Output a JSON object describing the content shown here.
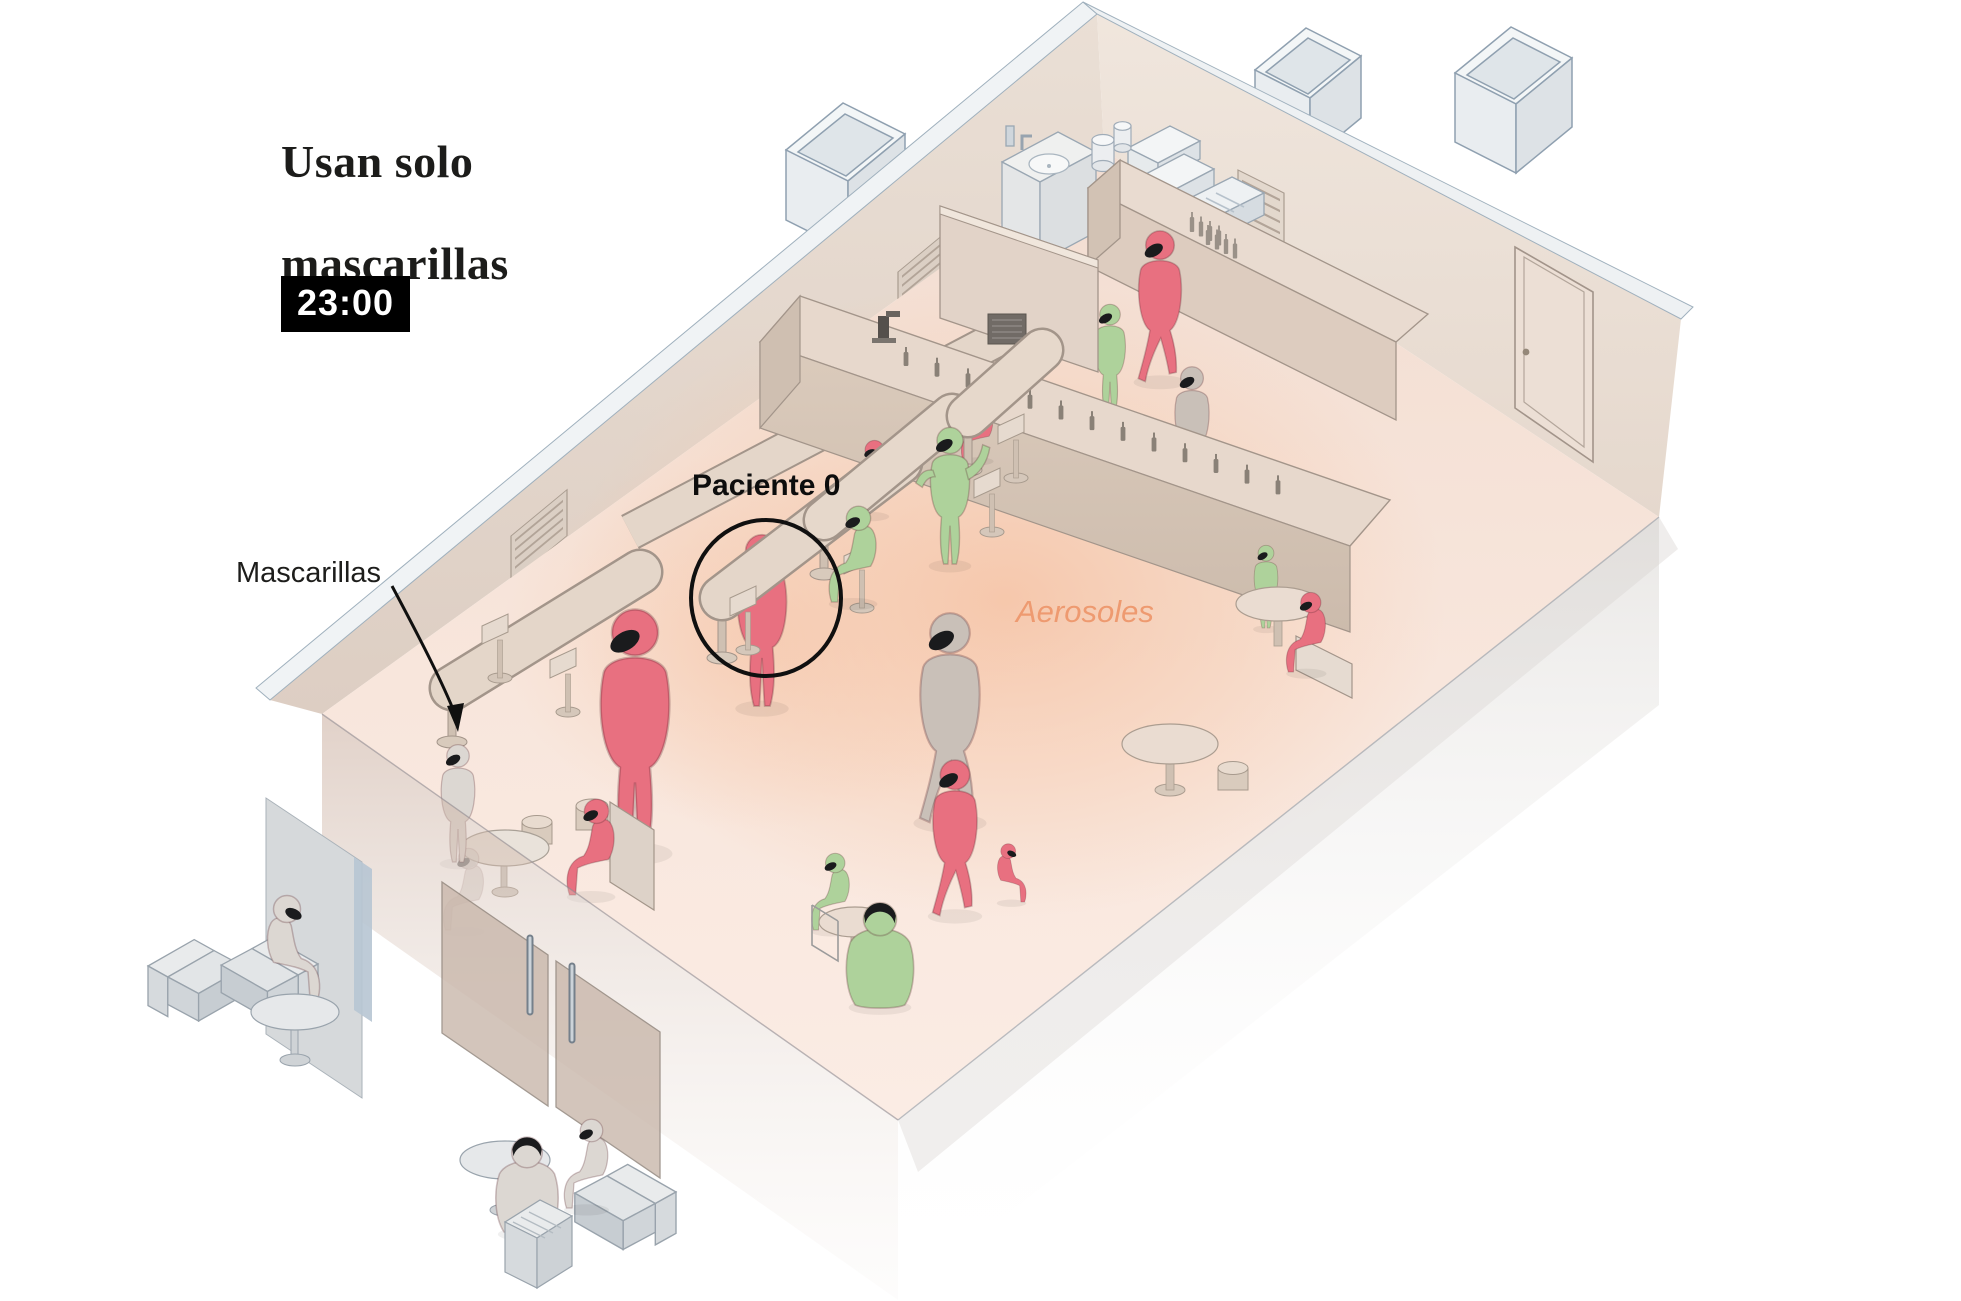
{
  "title": {
    "line1": "Usan solo",
    "line2": "mascarillas"
  },
  "time_badge": "23:00",
  "labels": {
    "mascarillas": "Mascarillas",
    "paciente0": "Paciente 0",
    "aerosoles": "Aerosoles"
  },
  "colors": {
    "red": "#e87080",
    "green": "#aed29b",
    "tan": "#c9c0b8",
    "gray": "#cfc9c4",
    "lightgray": "#dcd7d2",
    "mask": "#1a1b1d",
    "aerosol_text": "#ee9a70",
    "glow": "#f5c2a4",
    "wall": "#e7dacf",
    "floor": "#f8e7dd"
  },
  "people": [
    {
      "id": "paciente-0",
      "pose": "stand",
      "color": "red",
      "x": 762,
      "y": 706,
      "h": 178,
      "flip": false,
      "g": "a"
    },
    {
      "id": "red-companion",
      "pose": "stand",
      "color": "red",
      "x": 635,
      "y": 850,
      "h": 250,
      "flip": false,
      "g": "a"
    },
    {
      "id": "red-capped",
      "pose": "sit",
      "color": "red",
      "x": 885,
      "y": 515,
      "h": 105,
      "flip": false,
      "g": "a"
    },
    {
      "id": "red-at-ledge",
      "pose": "sit",
      "color": "red",
      "x": 990,
      "y": 460,
      "h": 90,
      "flip": false,
      "g": "a"
    },
    {
      "id": "green-seated-counter",
      "pose": "sit",
      "color": "green",
      "x": 872,
      "y": 602,
      "h": 135,
      "flip": false,
      "g": "b"
    },
    {
      "id": "green-gesturing",
      "pose": "gesture",
      "color": "green",
      "x": 950,
      "y": 564,
      "h": 142,
      "flip": false,
      "g": "b"
    },
    {
      "id": "green-bartender",
      "pose": "stand",
      "color": "green",
      "x": 1110,
      "y": 412,
      "h": 112,
      "flip": false,
      "g": "back"
    },
    {
      "id": "red-backbar",
      "pose": "walk",
      "color": "red",
      "x": 1160,
      "y": 380,
      "h": 155,
      "flip": false,
      "g": "back"
    },
    {
      "id": "staff-gray",
      "pose": "stand",
      "color": "tan",
      "x": 1192,
      "y": 486,
      "h": 124,
      "flip": false,
      "g": "back"
    },
    {
      "id": "gray-walker",
      "pose": "walk",
      "color": "tan",
      "x": 950,
      "y": 820,
      "h": 215,
      "flip": false,
      "g": "floor"
    },
    {
      "id": "red-walker",
      "pose": "walk",
      "color": "red",
      "x": 955,
      "y": 914,
      "h": 160,
      "flip": false,
      "g": "floor"
    },
    {
      "id": "red-small-seated",
      "pose": "sit",
      "color": "red",
      "x": 1000,
      "y": 902,
      "h": 82,
      "flip": true,
      "g": "floor"
    },
    {
      "id": "green-table-1",
      "pose": "sit",
      "color": "green",
      "x": 846,
      "y": 930,
      "h": 108,
      "flip": false,
      "g": "floor"
    },
    {
      "id": "green-table-2",
      "pose": "sitback",
      "color": "green",
      "x": 880,
      "y": 1005,
      "h": 165,
      "flip": false,
      "g": "floor2"
    },
    {
      "id": "green-bar-end",
      "pose": "stand",
      "color": "green",
      "x": 1266,
      "y": 628,
      "h": 86,
      "flip": false,
      "g": "right1"
    },
    {
      "id": "red-crosslegged",
      "pose": "sit",
      "color": "red",
      "x": 1322,
      "y": 672,
      "h": 112,
      "flip": false,
      "g": "right2"
    },
    {
      "id": "red-bench",
      "pose": "sit",
      "color": "red",
      "x": 610,
      "y": 895,
      "h": 135,
      "flip": false,
      "g": "left"
    },
    {
      "id": "gray-behind-glass",
      "pose": "sit",
      "color": "gray",
      "x": 480,
      "y": 930,
      "h": 115,
      "flip": false,
      "opacity": 0.5,
      "g": "left"
    },
    {
      "id": "gray-door",
      "pose": "stand",
      "color": "lightgray",
      "x": 458,
      "y": 862,
      "h": 122,
      "flip": false,
      "g": "left"
    },
    {
      "id": "outside-left",
      "pose": "sit",
      "color": "lightgray",
      "x": 272,
      "y": 1002,
      "h": 150,
      "flip": true,
      "g": "outside"
    },
    {
      "id": "outside-right-back",
      "pose": "sitback",
      "color": "lightgray",
      "x": 527,
      "y": 1232,
      "h": 153,
      "flip": false,
      "g": "outside"
    },
    {
      "id": "outside-right-chair",
      "pose": "sit",
      "color": "lightgray",
      "x": 604,
      "y": 1208,
      "h": 125,
      "flip": false,
      "g": "outside"
    }
  ]
}
